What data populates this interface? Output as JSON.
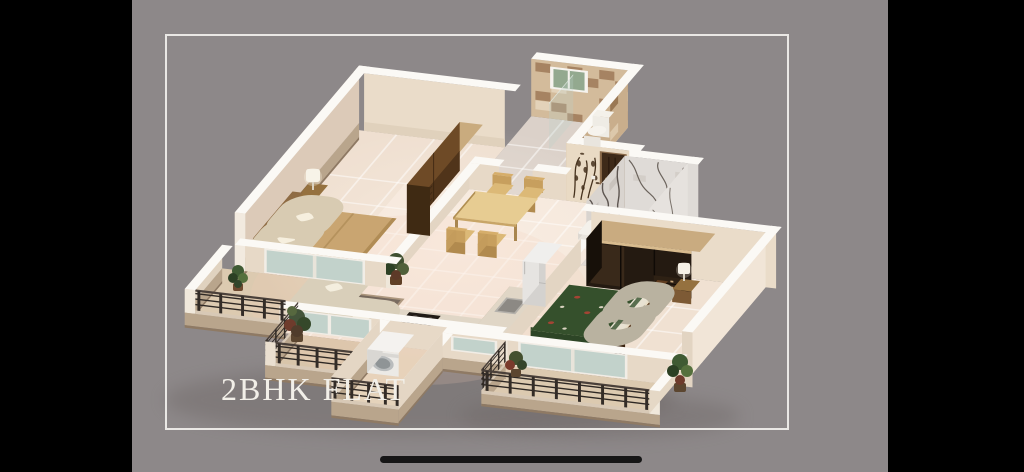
{
  "screen": {
    "width": 1024,
    "height": 472,
    "letterbox_color": "#000000"
  },
  "slide": {
    "background_color": "#8d8889",
    "frame_color": "#eae8e5",
    "title": "2BHK FLAT",
    "title_color": "#f2efe8"
  },
  "home_indicator": {
    "color": "#161616"
  },
  "floor_plan": {
    "type": "isometric-3d-apartment-render",
    "caption": "2BHK FLAT",
    "features": [
      "master-bedroom",
      "wooden-wardrobe",
      "double-bed",
      "bedside-lamp",
      "tiled-bathroom",
      "bathroom-window",
      "toilet",
      "dining-table",
      "dining-chairs",
      "floral-wall-art",
      "entry-door",
      "marble-bathroom",
      "washbasin",
      "living-sofa",
      "patterned-rug",
      "houseplants",
      "kitchen-counter",
      "cooktop",
      "sink",
      "refrigerator",
      "washing-machine",
      "second-bedroom",
      "dark-wardrobe",
      "green-paisley-bed",
      "balconies",
      "metal-railings",
      "sliding-glass-doors"
    ],
    "palette": {
      "wall_cream": "#e7d9c7",
      "wall_top_white": "#fbf9f5",
      "floor_tile": "#f5e7db",
      "bedroom_floor": "#efdfd0",
      "balcony_floor": "#dccab0",
      "wood_dark": "#50341a",
      "wood_mid": "#6e4a26",
      "wood_light": "#c8a97c",
      "bed_tan": "#c9a571",
      "bed_green": "#35502c",
      "accent_red": "#a44434",
      "sofa_cream": "#f2ecdc",
      "railing_metal": "#2e2824",
      "marble": "#d9d4cf",
      "tile_brown": "#a27e5c",
      "glass": "#b7cbc4",
      "door_brown": "#3e2a19",
      "plant_green": "#3f5a33"
    }
  }
}
